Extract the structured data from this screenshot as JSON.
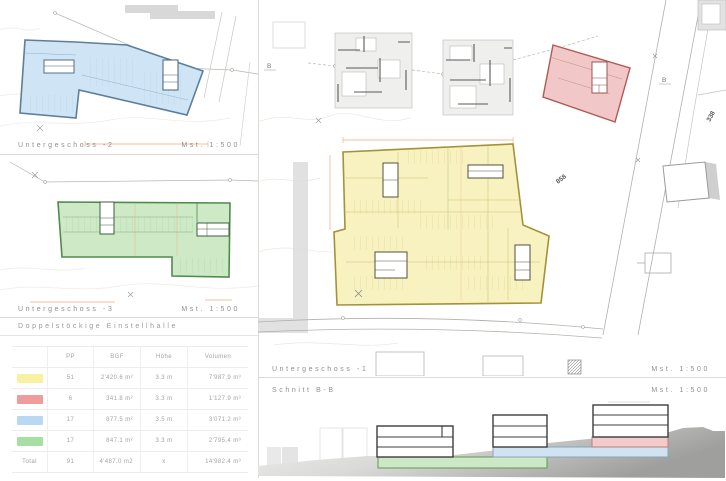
{
  "panels": {
    "ug2": {
      "title": "Untergeschoss -2",
      "scale": "Mst. 1:500"
    },
    "ug3": {
      "title": "Untergeschoss -3",
      "scale": "Mst. 1:500",
      "subtitle": "Doppelstöckige Einstellhalle"
    },
    "ug1": {
      "title": "Untergeschoss -1",
      "scale": "Mst. 1:500"
    },
    "section": {
      "title": "Schnitt B-B",
      "scale": "Mst. 1:500"
    }
  },
  "site": {
    "labels": {
      "section_mark_left": "B",
      "section_mark_right": "B",
      "parcel_338": "338",
      "parcel_858": "858"
    }
  },
  "colors": {
    "yellow_fill": "#f7f2c0",
    "yellow_stroke": "#a29339",
    "red_fill": "#f1c7c7",
    "red_stroke": "#ad5a55",
    "blue_fill": "#cfe4f4",
    "blue_stroke": "#5d7f99",
    "green_fill": "#cde9c6",
    "green_stroke": "#4f8c4a",
    "dim_orange": "#f3a97c"
  },
  "table": {
    "headers": [
      "PP",
      "BGF",
      "Höhe",
      "Volumen"
    ],
    "rows": [
      {
        "color": "#f8f1a2",
        "pp": "51",
        "bgf": "2'420.6 m²",
        "hoehe": "3.3 m",
        "volumen": "7'987.9 m³"
      },
      {
        "color": "#f09c9c",
        "pp": "6",
        "bgf": "341.8 m²",
        "hoehe": "3.3 m",
        "volumen": "1'127.9 m³"
      },
      {
        "color": "#b9d9f2",
        "pp": "17",
        "bgf": "877.5 m²",
        "hoehe": "3.5 m",
        "volumen": "3'071.2 m³"
      },
      {
        "color": "#a7dfa2",
        "pp": "17",
        "bgf": "847.1 m²",
        "hoehe": "3.3 m",
        "volumen": "2'795.4 m³"
      }
    ],
    "total": {
      "label": "Total",
      "pp": "91",
      "bgf": "4'487.0 m2",
      "hoehe": "x",
      "volumen": "14'982.4 m³"
    }
  }
}
